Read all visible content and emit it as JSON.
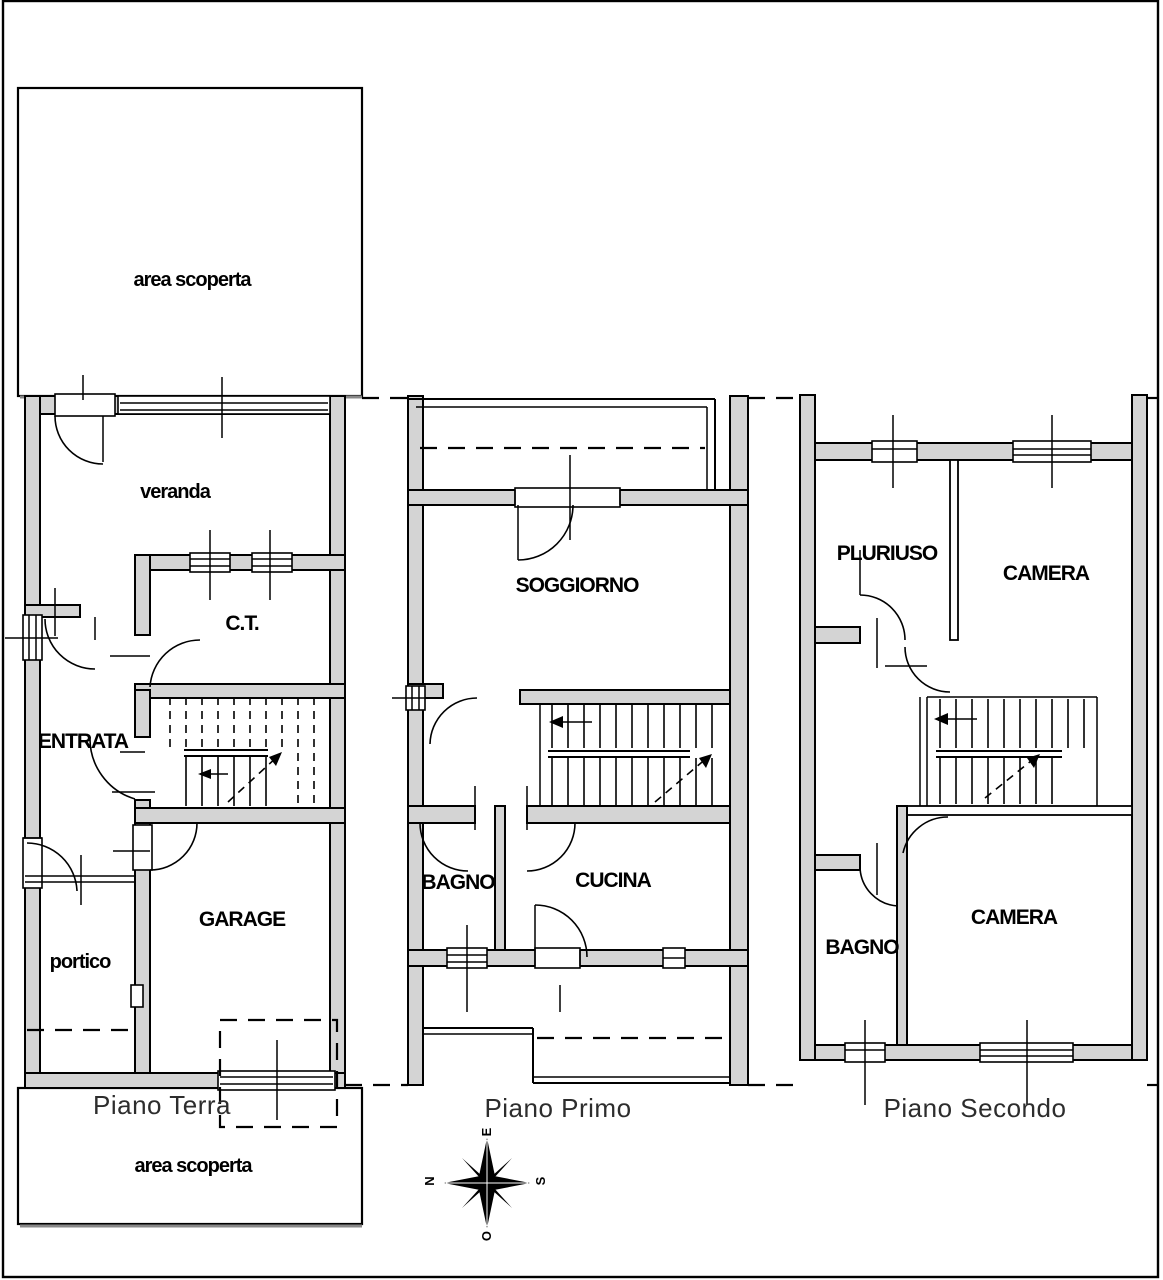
{
  "drawing": {
    "floors": {
      "terra": {
        "label": "Piano Terra",
        "rooms": {
          "area_scoperta_top": "area scoperta",
          "veranda": "veranda",
          "ct": "C.T.",
          "entrata": "ENTRATA",
          "garage": "GARAGE",
          "portico": "portico",
          "area_scoperta_bottom": "area scoperta"
        }
      },
      "primo": {
        "label": "Piano Primo",
        "rooms": {
          "soggiorno": "SOGGIORNO",
          "bagno": "BAGNO",
          "cucina": "CUCINA"
        }
      },
      "secondo": {
        "label": "Piano Secondo",
        "rooms": {
          "pluriuso": "PLURIUSO",
          "camera_top": "CAMERA",
          "bagno": "BAGNO",
          "camera_bottom": "CAMERA"
        }
      }
    },
    "compass": {
      "north": "N",
      "east": "E",
      "south": "S",
      "west": "O"
    },
    "colors": {
      "wall_fill": "#d4d4d4",
      "line": "#000000",
      "floor_label_color": "#2d2d2d",
      "background": "#ffffff"
    }
  }
}
